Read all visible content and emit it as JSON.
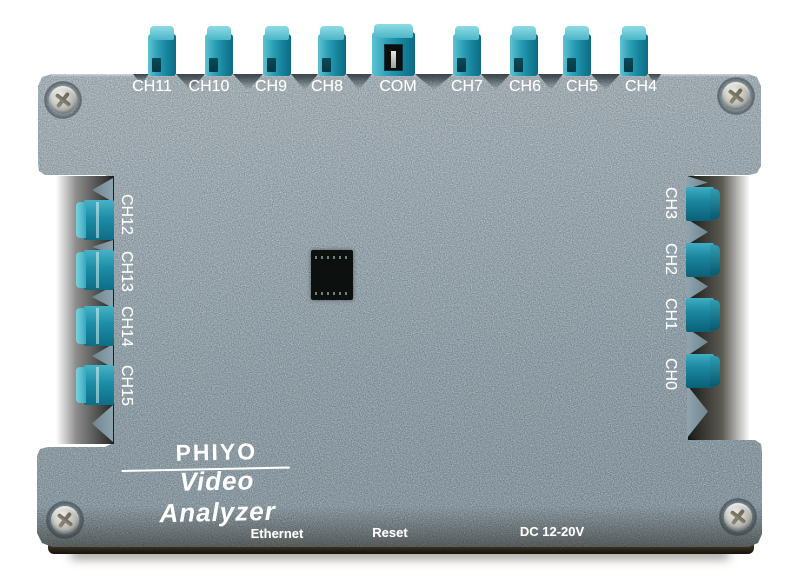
{
  "device": {
    "brand": "PHIYO",
    "product": "Video Analyzer"
  },
  "ports": {
    "top": [
      "CH11",
      "CH10",
      "CH9",
      "CH8",
      "COM",
      "CH7",
      "CH6",
      "CH5",
      "CH4"
    ],
    "left": [
      "CH12",
      "CH13",
      "CH14",
      "CH15"
    ],
    "right": [
      "CH3",
      "CH2",
      "CH1",
      "CH0"
    ]
  },
  "bottom_labels": {
    "ethernet": "Ethernet",
    "reset": "Reset",
    "power": "DC 12-20V"
  },
  "colors": {
    "chassis": "#8fa3ae",
    "connector_teal": "#2197b0",
    "text": "#ffffff"
  }
}
